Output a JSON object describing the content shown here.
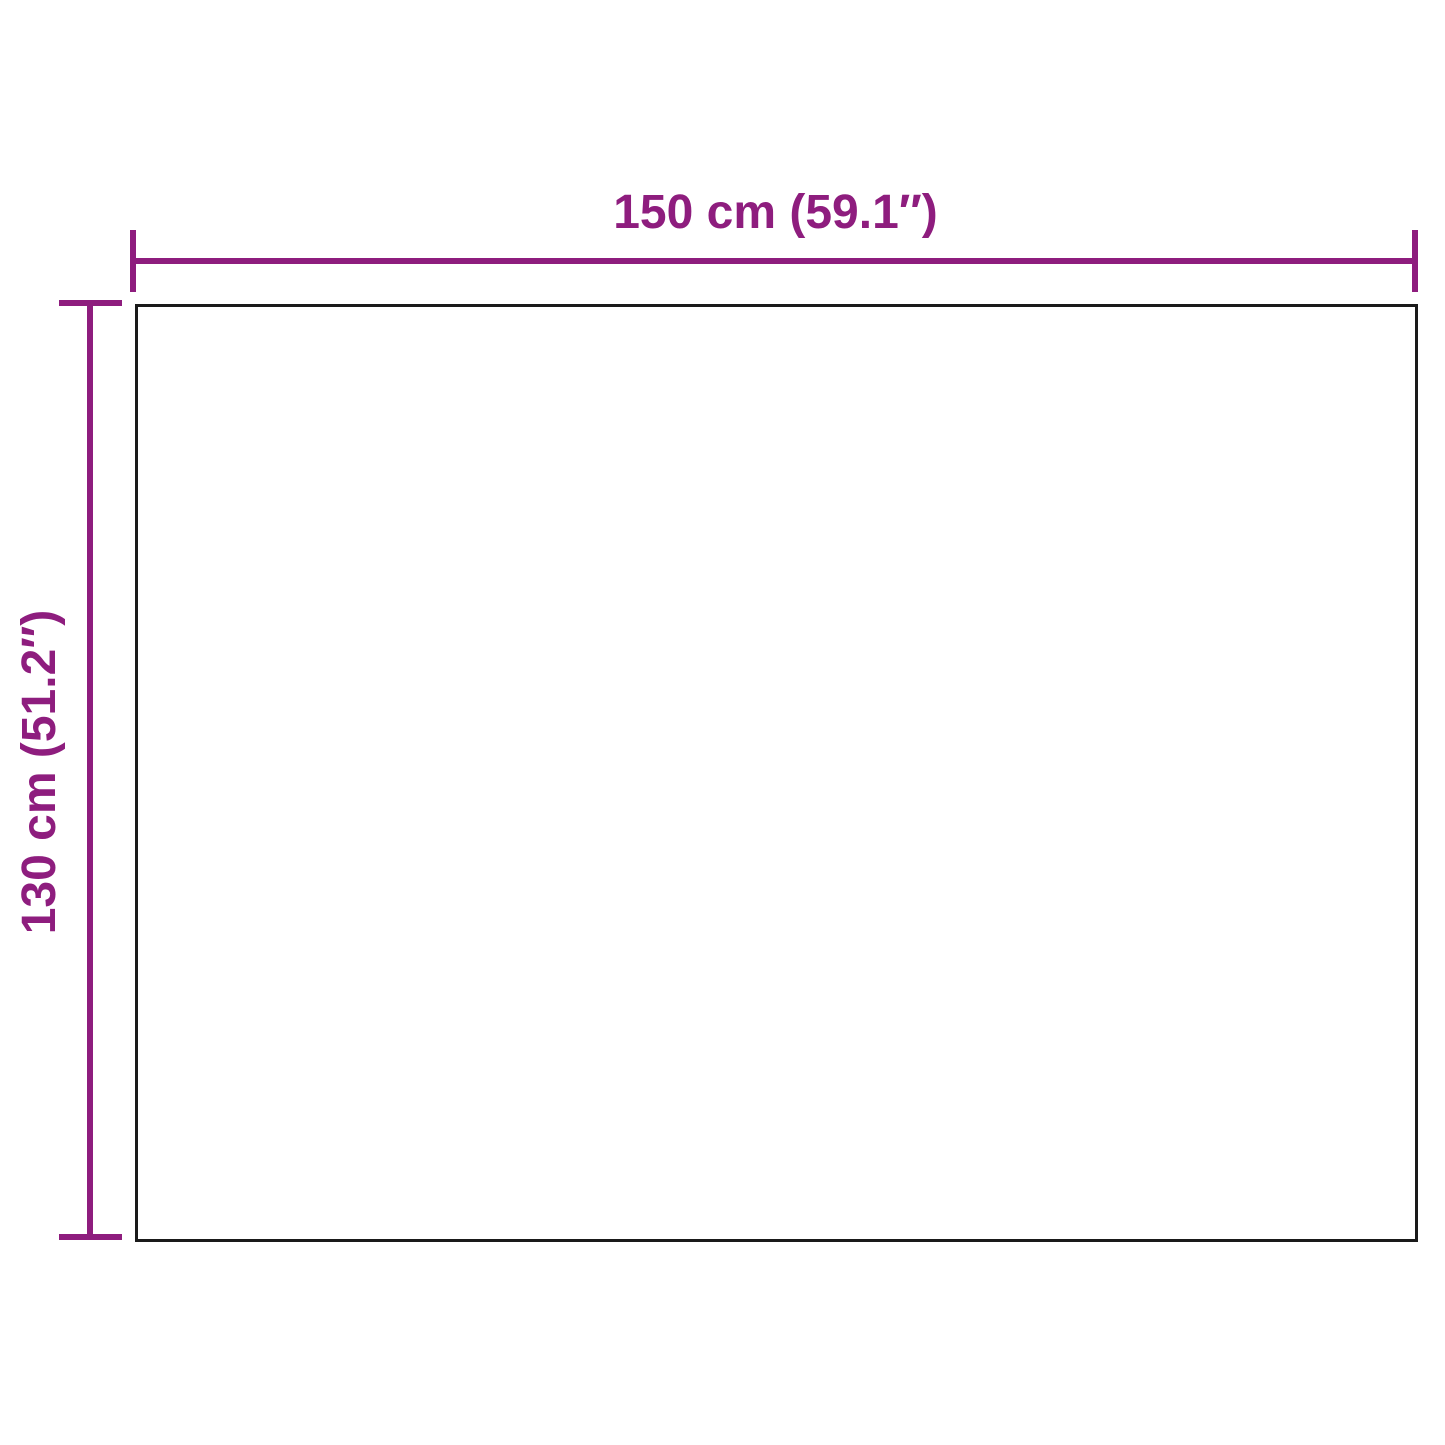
{
  "diagram": {
    "type": "product-dimension-diagram",
    "width_label": "150 cm (59.1″)",
    "height_label": "130 cm (51.2″)",
    "width_value_cm": 150,
    "width_value_in": 59.1,
    "height_value_cm": 130,
    "height_value_in": 51.2,
    "accent_color": "#8e1d7e",
    "outline_color": "#1a1a1a",
    "background_color": "#ffffff"
  }
}
